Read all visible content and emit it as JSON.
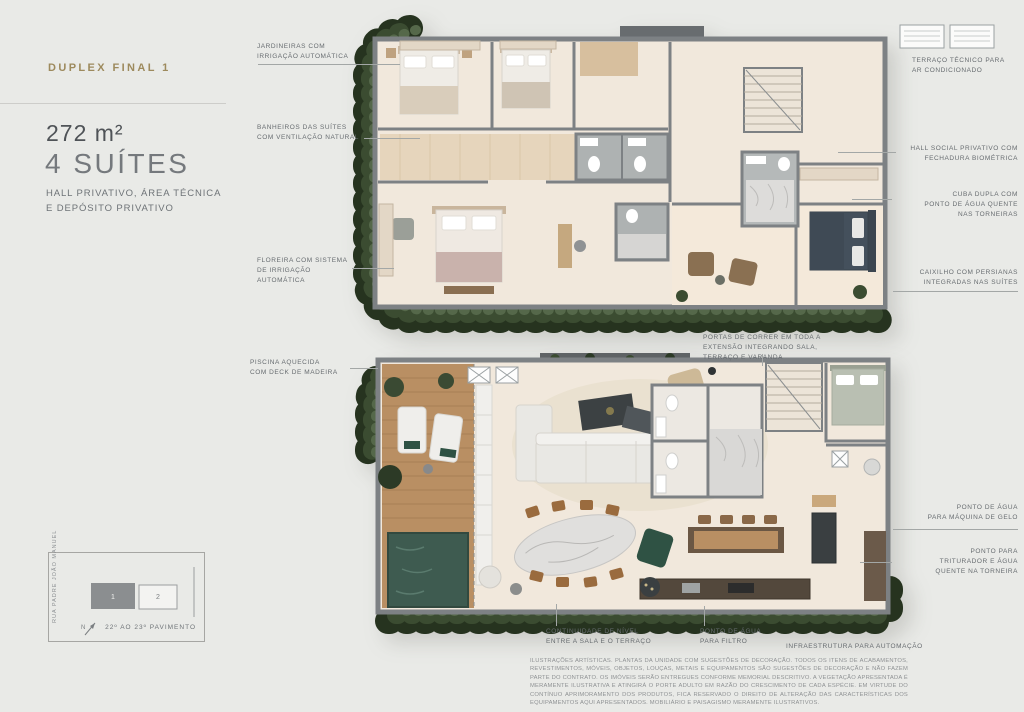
{
  "info_panel": {
    "title": "DUPLEX FINAL 1",
    "area": "272 m²",
    "suites": "4 SUÍTES",
    "description": "HALL PRIVATIVO, ÁREA TÉCNICA\nE DEPÓSITO PRIVATIVO"
  },
  "callouts": {
    "upper": [
      "JARDINEIRAS COM\nIRRIGAÇÃO AUTOMÁTICA",
      "BANHEIROS DAS SUÍTES\nCOM VENTILAÇÃO NATURAL",
      "FLOREIRA COM SISTEMA\nDE IRRIGAÇÃO\nAUTOMÁTICA",
      "TERRAÇO TÉCNICO PARA\nAR CONDICIONADO",
      "HALL SOCIAL PRIVATIVO COM\nFECHADURA BIOMÉTRICA",
      "CUBA DUPLA COM\nPONTO DE ÁGUA QUENTE\nNAS TORNEIRAS",
      "CAIXILHO COM PERSIANAS\nINTEGRADAS NAS SUÍTES"
    ],
    "lower": [
      "PISCINA AQUECIDA\nCOM DECK DE MADEIRA",
      "PORTAS DE CORRER EM TODA A\nEXTENSÃO INTEGRANDO SALA,\nTERRAÇO E VARANDA",
      "PONTO DE ÁGUA\nPARA MÁQUINA DE GELO",
      "PONTO PARA\nTRITURADOR E ÁGUA\nQUENTE NA TORNEIRA",
      "CONTINUIDADE DE NÍVEL\nENTRE A SALA E O TERRAÇO",
      "PONTO DE ÁGUA\nPARA FILTRO",
      "INFRAESTRUTURA PARA AUTOMAÇÃO"
    ]
  },
  "keyplan": {
    "street": "RUA PADRE JOÃO MANUEL",
    "floors": "22º AO 23º PAVIMENTO",
    "unit_highlighted": "1",
    "unit_other": "2",
    "north": "N"
  },
  "disclaimer": "ILUSTRAÇÕES ARTÍSTICAS. PLANTAS DA UNIDADE COM SUGESTÕES DE DECORAÇÃO. TODOS OS ITENS DE ACABAMENTOS, REVESTIMENTOS, MÓVEIS, OBJETOS, LOUÇAS, METAIS E EQUIPAMENTOS SÃO SUGESTÕES DE DECORAÇÃO E NÃO FAZEM PARTE DO CONTRATO. OS IMÓVEIS SERÃO ENTREGUES CONFORME MEMORIAL DESCRITIVO. A VEGETAÇÃO APRESENTADA É MERAMENTE ILUSTRATIVA E ATINGIRÁ O PORTE ADULTO EM RAZÃO DO CRESCIMENTO DE CADA ESPÉCIE. EM VIRTUDE DO CONTÍNUO APRIMORAMENTO DOS PRODUTOS, FICA RESERVADO O DIREITO DE ALTERAÇÃO DAS CARACTERÍSTICAS DOS EQUIPAMENTOS AQUI APRESENTADOS. MOBILIÁRIO E PAISAGISMO MERAMENTE ILUSTRATIVOS.",
  "colors": {
    "accent_gold": "#9d8a5d",
    "wall_gray": "#7d8184",
    "floor_cream": "#f1e8dc",
    "deck_wood": "#b98f63",
    "pool_green": "#3e5b50",
    "vegetation_green": "#26331f",
    "accent_chair_green": "#2f5244"
  }
}
